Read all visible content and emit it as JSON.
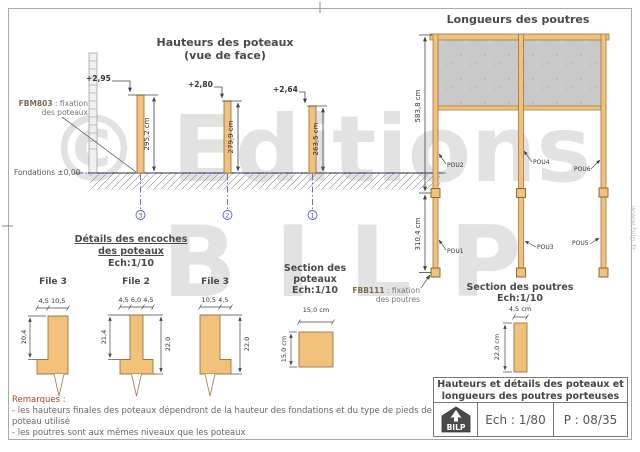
{
  "watermark": {
    "line1": "© Editions",
    "line2": "BILP",
    "website": "www.bilp.fr"
  },
  "elevation": {
    "title": "Hauteurs des poteaux",
    "subtitle": "(vue de face)",
    "fixation_code": "FBM803",
    "fixation_text": " : fixation",
    "fixation_text2": "des poteaux",
    "foundation_label": "Fondations ±0,00",
    "posts": [
      {
        "level": "+2,95",
        "height": "295,2 cm",
        "axis": "3"
      },
      {
        "level": "+2,80",
        "height": "279,9 cm",
        "axis": "2"
      },
      {
        "level": "+2,64",
        "height": "263,5 cm",
        "axis": "1"
      }
    ]
  },
  "details": {
    "title": "Détails des encoches",
    "title2": "des poteaux",
    "scale": "Ech:1/10",
    "files": [
      {
        "label": "File 3",
        "top_dims": "4,5  10,5",
        "side_dim": "20,4"
      },
      {
        "label": "File 2",
        "top_dims": "4,5 6,0 4,5",
        "side_dim": "21,4",
        "right_dim": "22,0"
      },
      {
        "label": "File 3",
        "top_dims": "10,5  4,5",
        "right_dim": "22,0"
      }
    ]
  },
  "post_section": {
    "title": "Section des",
    "title2": "poteaux",
    "scale": "Ech:1/10",
    "width_dim": "15,0 cm",
    "height_dim": "15,0 cm"
  },
  "beam_fixation": {
    "code": "FBB111",
    "text": " : fixation",
    "text2": "des poutres"
  },
  "beam_plan": {
    "title": "Longueurs des poutres",
    "upper_dim": "583,8 cm",
    "lower_dim": "310,4 cm",
    "beams_upper": [
      "POU2",
      "POU4",
      "POU6"
    ],
    "beams_lower": [
      "POU1",
      "POU3",
      "POU5"
    ]
  },
  "beam_section": {
    "title": "Section des poutres",
    "scale": "Ech:1/10",
    "width_dim": "4,5 cm",
    "height_dim": "22,0 cm"
  },
  "title_block": {
    "title_line1": "Hauteurs et détails des poteaux et",
    "title_line2": "longueurs des poutres porteuses",
    "logo": "BILP",
    "scale": "Ech : 1/80",
    "page": "P : 08/35"
  },
  "remarks": {
    "heading": "Remarques :",
    "lines": [
      "- les hauteurs finales des poteaux dépendront de la hauteur des fondations et du type de pieds de",
      "poteau utilisé",
      "- les poutres sont aux mêmes niveaux que les poteaux"
    ]
  },
  "colors": {
    "wood": "#F2C17C",
    "wood_border": "#9A7840",
    "panel": "#C9C9C9",
    "axis_blue": "#5A5AC8",
    "remark_red": "#C23B2F"
  }
}
